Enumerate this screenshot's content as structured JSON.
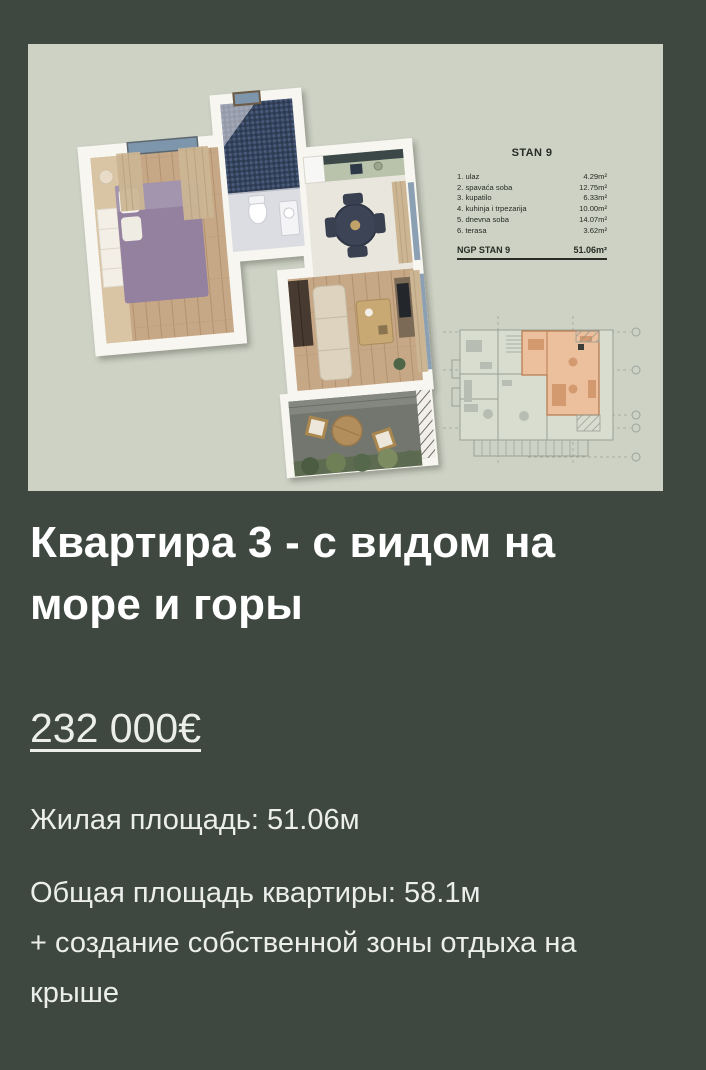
{
  "theme": {
    "page_bg": "#3e4840",
    "card_bg": "#cdd2c5",
    "title_color": "#ffffff",
    "text_color": "#eceeec",
    "highlight_unit_color": "#ecbf9d",
    "legend_text_color": "#272c24"
  },
  "listing": {
    "title": "Квартира 3 - с видом на море и горы",
    "price": "232 000€",
    "living_area": "Жилая площадь: 51.06м",
    "total_area": "Общая площадь квартиры: 58.1м",
    "roof_bonus": "+ создание собственной зоны отдыха на крыше"
  },
  "floorplan_image": {
    "legend": {
      "title": "STAN 9",
      "rooms": [
        {
          "label": "1. ulaz",
          "area": "4.29m²"
        },
        {
          "label": "2. spavaća soba",
          "area": "12.75m²"
        },
        {
          "label": "3. kupatilo",
          "area": "6.33m²"
        },
        {
          "label": "4. kuhinja i trpezarija",
          "area": "10.00m²"
        },
        {
          "label": "5. dnevna soba",
          "area": "14.07m²"
        },
        {
          "label": "6. terasa",
          "area": "3.62m²"
        }
      ],
      "total_label": "NGP STAN 9",
      "total_area": "51.06m²"
    }
  }
}
